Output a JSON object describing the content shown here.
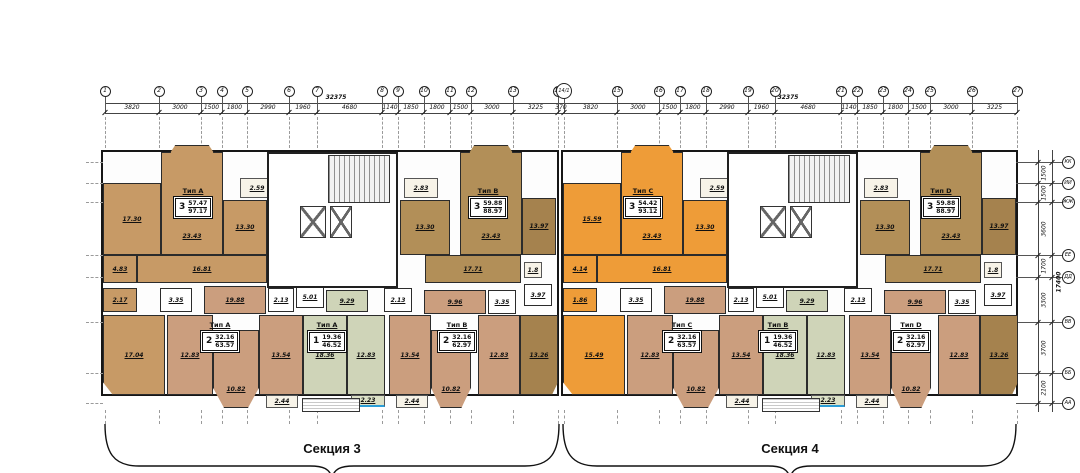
{
  "drawing": {
    "kind": "floor-plan"
  },
  "colors": {
    "tan": "#c79a66",
    "brn": "#b28f58",
    "brn2": "#a5824e",
    "org": "#ee9c38",
    "sal": "#cb9e7e",
    "grn": "#cfd4b8",
    "grnb": "#dde2c8",
    "bal": "#f7f3e8",
    "wc": "#ffffff",
    "wall": "#222222",
    "accent_blue": "#2d9fd8"
  },
  "top_axes": {
    "numbers": [
      "1",
      "2",
      "3",
      "4",
      "5",
      "6",
      "7",
      "8",
      "9",
      "10",
      "11",
      "12",
      "13",
      "14",
      "14/1",
      "15",
      "16",
      "17",
      "18",
      "19",
      "20",
      "21",
      "22",
      "23",
      "24",
      "25",
      "26",
      "27"
    ],
    "x": [
      105,
      159,
      201,
      222,
      247,
      289,
      317,
      382,
      398,
      424,
      450,
      471,
      513,
      558,
      564,
      617,
      659,
      680,
      706,
      748,
      775,
      841,
      857,
      883,
      908,
      930,
      972,
      1017
    ],
    "dims": [
      "3820",
      "3000",
      "1500",
      "1800",
      "2990",
      "1960",
      "4680",
      "1140",
      "1850",
      "1800",
      "1500",
      "3000",
      "3225",
      "370",
      "3820",
      "3000",
      "1500",
      "1800",
      "2990",
      "1960",
      "4680",
      "1140",
      "1850",
      "1800",
      "1500",
      "3000",
      "3225"
    ],
    "overall": [
      {
        "v": "32375",
        "x": 336
      },
      {
        "v": "32375",
        "x": 788
      }
    ]
  },
  "right_axes": {
    "letters": [
      {
        "n": "КК",
        "y": 162
      },
      {
        "n": "ИИ",
        "y": 183
      },
      {
        "n": "ЖЖ",
        "y": 202
      },
      {
        "n": "ЕЕ",
        "y": 255
      },
      {
        "n": "ДД",
        "y": 277
      },
      {
        "n": "ВВ",
        "y": 322
      },
      {
        "n": "ББ",
        "y": 373
      },
      {
        "n": "АА",
        "y": 403
      }
    ],
    "dims": [
      "1500",
      "1500",
      "3600",
      "1700",
      "3300",
      "3700",
      "2100"
    ],
    "overall": "17400"
  },
  "sections": [
    {
      "label": "Секция 3",
      "outline": {
        "x": 101,
        "y": 150,
        "w": 458,
        "h": 246
      },
      "brace": {
        "x1": 105,
        "x2": 559,
        "xc": 332
      }
    },
    {
      "label": "Секция 4",
      "outline": {
        "x": 561,
        "y": 150,
        "w": 457,
        "h": 246
      },
      "brace": {
        "x1": 563,
        "x2": 1016,
        "xc": 790
      }
    }
  ],
  "apartments": [
    {
      "x": 173,
      "y": 196,
      "type": "Тип А",
      "rooms": "3",
      "living": "57.47",
      "total": "97.17"
    },
    {
      "x": 468,
      "y": 196,
      "type": "Тип В",
      "rooms": "3",
      "living": "59.88",
      "total": "88.97"
    },
    {
      "x": 623,
      "y": 196,
      "type": "Тип С",
      "rooms": "3",
      "living": "54.42",
      "total": "93.12"
    },
    {
      "x": 921,
      "y": 196,
      "type": "Тип D",
      "rooms": "3",
      "living": "59.88",
      "total": "88.97"
    },
    {
      "x": 200,
      "y": 330,
      "type": "Тип А",
      "rooms": "2",
      "living": "32.16",
      "total": "63.57"
    },
    {
      "x": 307,
      "y": 330,
      "type": "Тип А",
      "rooms": "1",
      "living": "19.36",
      "total": "46.52"
    },
    {
      "x": 437,
      "y": 330,
      "type": "Тип В",
      "rooms": "2",
      "living": "32.16",
      "total": "62.97"
    },
    {
      "x": 662,
      "y": 330,
      "type": "Тип С",
      "rooms": "2",
      "living": "32.16",
      "total": "63.57"
    },
    {
      "x": 758,
      "y": 330,
      "type": "Тип В",
      "rooms": "1",
      "living": "19.36",
      "total": "46.52"
    },
    {
      "x": 891,
      "y": 330,
      "type": "Тип D",
      "rooms": "2",
      "living": "32.16",
      "total": "62.97"
    }
  ],
  "rooms": [
    {
      "x": 103,
      "y": 183,
      "w": 58,
      "h": 72,
      "c": "tan",
      "v": "17.30"
    },
    {
      "x": 161,
      "y": 152,
      "w": 62,
      "h": 103,
      "c": "tan",
      "v": "23.43",
      "low": true
    },
    {
      "x": 223,
      "y": 200,
      "w": 44,
      "h": 55,
      "c": "tan",
      "v": "13.30"
    },
    {
      "x": 240,
      "y": 178,
      "w": 34,
      "h": 20,
      "c": "bal",
      "v": "2.59"
    },
    {
      "x": 103,
      "y": 255,
      "w": 34,
      "h": 28,
      "c": "tan",
      "v": "4.83"
    },
    {
      "x": 137,
      "y": 255,
      "w": 130,
      "h": 28,
      "c": "tan",
      "v": "16.81"
    },
    {
      "x": 103,
      "y": 288,
      "w": 34,
      "h": 24,
      "c": "tan",
      "v": "2.17"
    },
    {
      "x": 160,
      "y": 288,
      "w": 32,
      "h": 24,
      "c": "wc",
      "v": "3.35"
    },
    {
      "x": 204,
      "y": 286,
      "w": 62,
      "h": 28,
      "c": "sal",
      "v": "19.88"
    },
    {
      "x": 268,
      "y": 288,
      "w": 26,
      "h": 24,
      "c": "wc",
      "v": "2.13"
    },
    {
      "x": 296,
      "y": 286,
      "w": 28,
      "h": 22,
      "c": "wc",
      "v": "5.01"
    },
    {
      "x": 326,
      "y": 290,
      "w": 42,
      "h": 22,
      "c": "grn",
      "v": "9.29"
    },
    {
      "x": 384,
      "y": 288,
      "w": 28,
      "h": 24,
      "c": "wc",
      "v": "2.13"
    },
    {
      "x": 424,
      "y": 290,
      "w": 62,
      "h": 24,
      "c": "sal",
      "v": "9.96"
    },
    {
      "x": 488,
      "y": 290,
      "w": 28,
      "h": 24,
      "c": "wc",
      "v": "3.35"
    },
    {
      "x": 404,
      "y": 178,
      "w": 34,
      "h": 20,
      "c": "bal",
      "v": "2.83"
    },
    {
      "x": 400,
      "y": 200,
      "w": 50,
      "h": 55,
      "c": "brn",
      "v": "13.30"
    },
    {
      "x": 460,
      "y": 152,
      "w": 62,
      "h": 103,
      "c": "brn",
      "v": "23.43",
      "low": true
    },
    {
      "x": 522,
      "y": 198,
      "w": 34,
      "h": 57,
      "c": "brn2",
      "v": "13.97"
    },
    {
      "x": 425,
      "y": 255,
      "w": 96,
      "h": 28,
      "c": "brn",
      "v": "17.71"
    },
    {
      "x": 524,
      "y": 262,
      "w": 18,
      "h": 16,
      "c": "bal",
      "v": "1.8"
    },
    {
      "x": 524,
      "y": 284,
      "w": 28,
      "h": 22,
      "c": "wc",
      "v": "3.97"
    },
    {
      "x": 520,
      "y": 315,
      "w": 38,
      "h": 80,
      "c": "brn2",
      "v": "13.26",
      "clip": "br"
    },
    {
      "x": 103,
      "y": 315,
      "w": 62,
      "h": 80,
      "c": "tan",
      "v": "17.04",
      "clip": "bl"
    },
    {
      "x": 167,
      "y": 315,
      "w": 46,
      "h": 80,
      "c": "sal",
      "v": "12.83"
    },
    {
      "x": 213,
      "y": 330,
      "w": 46,
      "h": 78,
      "c": "sal",
      "v": "10.82",
      "clip": "kit",
      "low": true
    },
    {
      "x": 259,
      "y": 315,
      "w": 44,
      "h": 80,
      "c": "sal",
      "v": "13.54"
    },
    {
      "x": 266,
      "y": 395,
      "w": 32,
      "h": 13,
      "c": "bal",
      "v": "2.44"
    },
    {
      "x": 303,
      "y": 315,
      "w": 44,
      "h": 80,
      "c": "grn",
      "v": "18.36"
    },
    {
      "x": 347,
      "y": 315,
      "w": 38,
      "h": 80,
      "c": "grn",
      "v": "12.83"
    },
    {
      "x": 351,
      "y": 395,
      "w": 34,
      "h": 12,
      "c": "grnb",
      "v": "2.23",
      "accent": true
    },
    {
      "x": 389,
      "y": 315,
      "w": 42,
      "h": 80,
      "c": "sal",
      "v": "13.54"
    },
    {
      "x": 431,
      "y": 330,
      "w": 40,
      "h": 78,
      "c": "sal",
      "v": "10.82",
      "clip": "kit",
      "low": true
    },
    {
      "x": 478,
      "y": 315,
      "w": 42,
      "h": 80,
      "c": "sal",
      "v": "12.83"
    },
    {
      "x": 396,
      "y": 395,
      "w": 32,
      "h": 13,
      "c": "bal",
      "v": "2.44"
    },
    {
      "x": 563,
      "y": 183,
      "w": 58,
      "h": 72,
      "c": "org",
      "v": "15.59"
    },
    {
      "x": 621,
      "y": 152,
      "w": 62,
      "h": 103,
      "c": "org",
      "v": "23.43",
      "low": true
    },
    {
      "x": 683,
      "y": 200,
      "w": 44,
      "h": 55,
      "c": "org",
      "v": "13.30"
    },
    {
      "x": 700,
      "y": 178,
      "w": 34,
      "h": 20,
      "c": "bal",
      "v": "2.59"
    },
    {
      "x": 563,
      "y": 255,
      "w": 34,
      "h": 28,
      "c": "org",
      "v": "4.14"
    },
    {
      "x": 597,
      "y": 255,
      "w": 130,
      "h": 28,
      "c": "org",
      "v": "16.81"
    },
    {
      "x": 563,
      "y": 288,
      "w": 34,
      "h": 24,
      "c": "org",
      "v": "1.86"
    },
    {
      "x": 620,
      "y": 288,
      "w": 32,
      "h": 24,
      "c": "wc",
      "v": "3.35"
    },
    {
      "x": 664,
      "y": 286,
      "w": 62,
      "h": 28,
      "c": "sal",
      "v": "19.88"
    },
    {
      "x": 728,
      "y": 288,
      "w": 26,
      "h": 24,
      "c": "wc",
      "v": "2.13"
    },
    {
      "x": 756,
      "y": 286,
      "w": 28,
      "h": 22,
      "c": "wc",
      "v": "5.01"
    },
    {
      "x": 786,
      "y": 290,
      "w": 42,
      "h": 22,
      "c": "grn",
      "v": "9.29"
    },
    {
      "x": 844,
      "y": 288,
      "w": 28,
      "h": 24,
      "c": "wc",
      "v": "2.13"
    },
    {
      "x": 884,
      "y": 290,
      "w": 62,
      "h": 24,
      "c": "sal",
      "v": "9.96"
    },
    {
      "x": 948,
      "y": 290,
      "w": 28,
      "h": 24,
      "c": "wc",
      "v": "3.35"
    },
    {
      "x": 864,
      "y": 178,
      "w": 34,
      "h": 20,
      "c": "bal",
      "v": "2.83"
    },
    {
      "x": 860,
      "y": 200,
      "w": 50,
      "h": 55,
      "c": "brn",
      "v": "13.30"
    },
    {
      "x": 920,
      "y": 152,
      "w": 62,
      "h": 103,
      "c": "brn",
      "v": "23.43",
      "low": true
    },
    {
      "x": 982,
      "y": 198,
      "w": 34,
      "h": 57,
      "c": "brn2",
      "v": "13.97"
    },
    {
      "x": 885,
      "y": 255,
      "w": 96,
      "h": 28,
      "c": "brn",
      "v": "17.71"
    },
    {
      "x": 984,
      "y": 262,
      "w": 18,
      "h": 16,
      "c": "bal",
      "v": "1.8"
    },
    {
      "x": 984,
      "y": 284,
      "w": 28,
      "h": 22,
      "c": "wc",
      "v": "3.97"
    },
    {
      "x": 980,
      "y": 315,
      "w": 38,
      "h": 80,
      "c": "brn2",
      "v": "13.26",
      "clip": "br"
    },
    {
      "x": 563,
      "y": 315,
      "w": 62,
      "h": 80,
      "c": "org",
      "v": "15.49",
      "clip": "bl"
    },
    {
      "x": 627,
      "y": 315,
      "w": 46,
      "h": 80,
      "c": "sal",
      "v": "12.83"
    },
    {
      "x": 673,
      "y": 330,
      "w": 46,
      "h": 78,
      "c": "sal",
      "v": "10.82",
      "clip": "kit",
      "low": true
    },
    {
      "x": 719,
      "y": 315,
      "w": 44,
      "h": 80,
      "c": "sal",
      "v": "13.54"
    },
    {
      "x": 726,
      "y": 395,
      "w": 32,
      "h": 13,
      "c": "bal",
      "v": "2.44"
    },
    {
      "x": 763,
      "y": 315,
      "w": 44,
      "h": 80,
      "c": "grn",
      "v": "18.36"
    },
    {
      "x": 807,
      "y": 315,
      "w": 38,
      "h": 80,
      "c": "grn",
      "v": "12.83"
    },
    {
      "x": 811,
      "y": 395,
      "w": 34,
      "h": 12,
      "c": "grnb",
      "v": "2.23",
      "accent": true
    },
    {
      "x": 849,
      "y": 315,
      "w": 42,
      "h": 80,
      "c": "sal",
      "v": "13.54"
    },
    {
      "x": 891,
      "y": 330,
      "w": 40,
      "h": 78,
      "c": "sal",
      "v": "10.82",
      "clip": "kit",
      "low": true
    },
    {
      "x": 938,
      "y": 315,
      "w": 42,
      "h": 80,
      "c": "sal",
      "v": "12.83"
    },
    {
      "x": 856,
      "y": 395,
      "w": 32,
      "h": 13,
      "c": "bal",
      "v": "2.44"
    }
  ],
  "bays": [
    {
      "x": 170,
      "y": 145,
      "w": 44,
      "h": 8,
      "c": "tan"
    },
    {
      "x": 469,
      "y": 145,
      "w": 44,
      "h": 8,
      "c": "brn"
    },
    {
      "x": 630,
      "y": 145,
      "w": 44,
      "h": 8,
      "c": "org"
    },
    {
      "x": 929,
      "y": 145,
      "w": 44,
      "h": 8,
      "c": "brn"
    }
  ],
  "cores": [
    {
      "x": 267,
      "y": 152,
      "w": 131,
      "h": 136,
      "stairs": {
        "x": 328,
        "y": 155,
        "w": 62,
        "h": 48
      },
      "elevs": [
        {
          "x": 300,
          "y": 206,
          "w": 26,
          "h": 32
        },
        {
          "x": 330,
          "y": 206,
          "w": 22,
          "h": 32
        }
      ],
      "porch": {
        "x": 302,
        "y": 398,
        "w": 58,
        "h": 14
      }
    },
    {
      "x": 727,
      "y": 152,
      "w": 131,
      "h": 136,
      "stairs": {
        "x": 788,
        "y": 155,
        "w": 62,
        "h": 48
      },
      "elevs": [
        {
          "x": 760,
          "y": 206,
          "w": 26,
          "h": 32
        },
        {
          "x": 790,
          "y": 206,
          "w": 22,
          "h": 32
        }
      ],
      "porch": {
        "x": 762,
        "y": 398,
        "w": 58,
        "h": 14
      }
    }
  ]
}
